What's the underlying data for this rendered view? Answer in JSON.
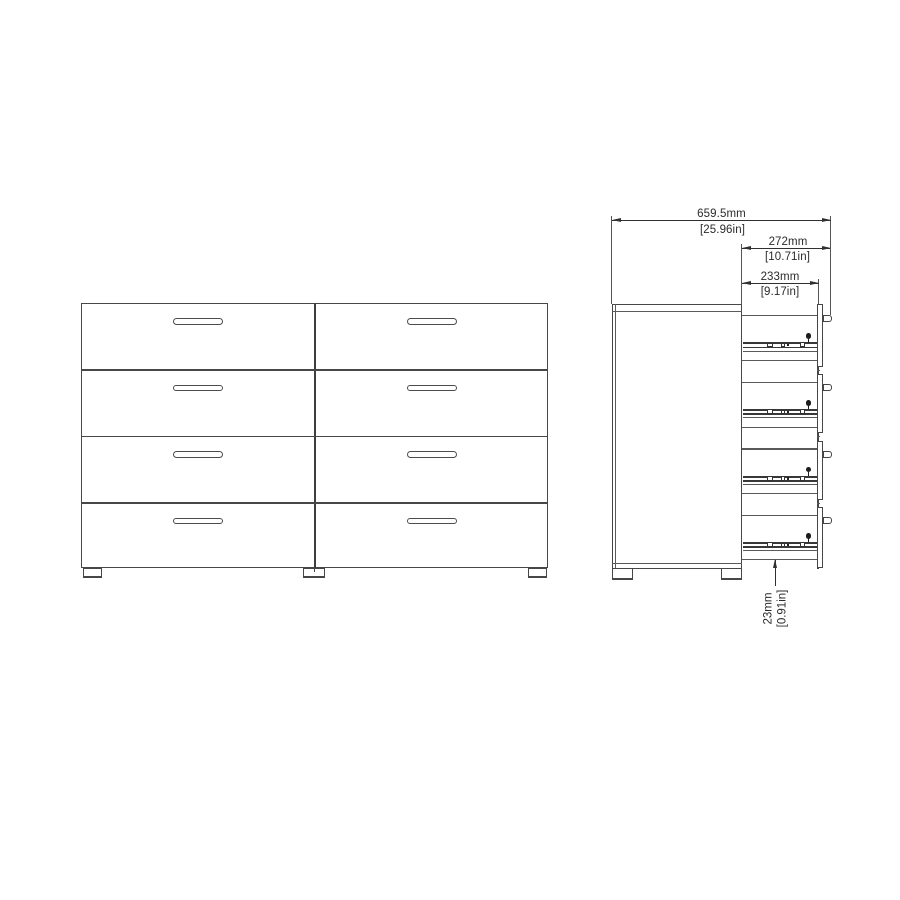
{
  "figure": {
    "kind": "furniture-dimension-diagram",
    "subject": "double dresser with 8 drawers, front elevation and side cross-section",
    "background_color": "#ffffff",
    "line_color": "#474747"
  },
  "front_view": {
    "drawer_rows": 4,
    "drawer_columns": 2,
    "handle_slots": 8,
    "feet": 3
  },
  "side_view": {
    "drawers": 4,
    "slide_rails": 4,
    "handles": 4,
    "feet": 2
  },
  "dims": {
    "total": {
      "mm": "659.5mm",
      "inch": "[25.96in]"
    },
    "handle_depth": {
      "mm": "272mm",
      "inch": "[10.71in]"
    },
    "drawer_depth": {
      "mm": "233mm",
      "inch": "[9.17in]"
    },
    "base": {
      "mm": "23mm",
      "inch": "[0.91in]"
    }
  }
}
